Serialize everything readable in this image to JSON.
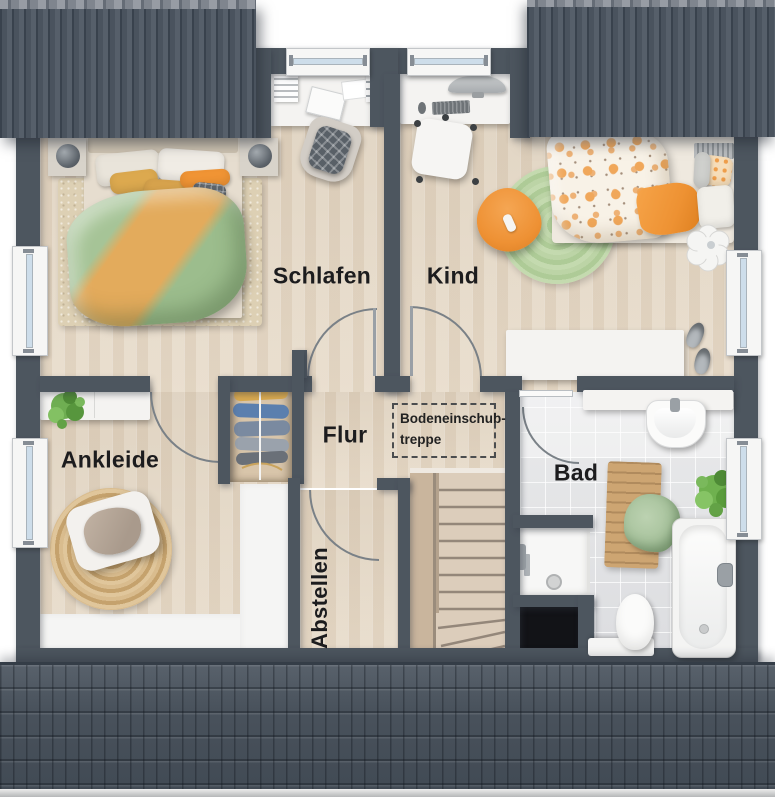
{
  "plan": {
    "rooms": [
      {
        "id": "schlafen",
        "label": "Schlafen"
      },
      {
        "id": "kind",
        "label": "Kind"
      },
      {
        "id": "ankleide",
        "label": "Ankleide"
      },
      {
        "id": "flur",
        "label": "Flur"
      },
      {
        "id": "abstellen",
        "label": "Abstellen"
      },
      {
        "id": "bad",
        "label": "Bad"
      }
    ],
    "annotation": {
      "line1": "Bodeneinschub-",
      "line2": "treppe"
    }
  },
  "palette": {
    "wall": "#4d565f",
    "roof": "#4a535e",
    "floor_wood": "#e7dbc9",
    "floor_tile": "#e1e2e4",
    "low_floor_white": "#f5f5f4",
    "accent_orange": "#ee9a3f",
    "duvet_green": "#a5c496",
    "rug_green": "#b8d2a2",
    "jute_rug": "#d2b382",
    "furniture_white": "#f4f3f1",
    "stairs_wood": "#d9c9b7",
    "niche_black": "#121317",
    "window_glass": "#cdddea",
    "label_text": "#1c1c1e"
  }
}
